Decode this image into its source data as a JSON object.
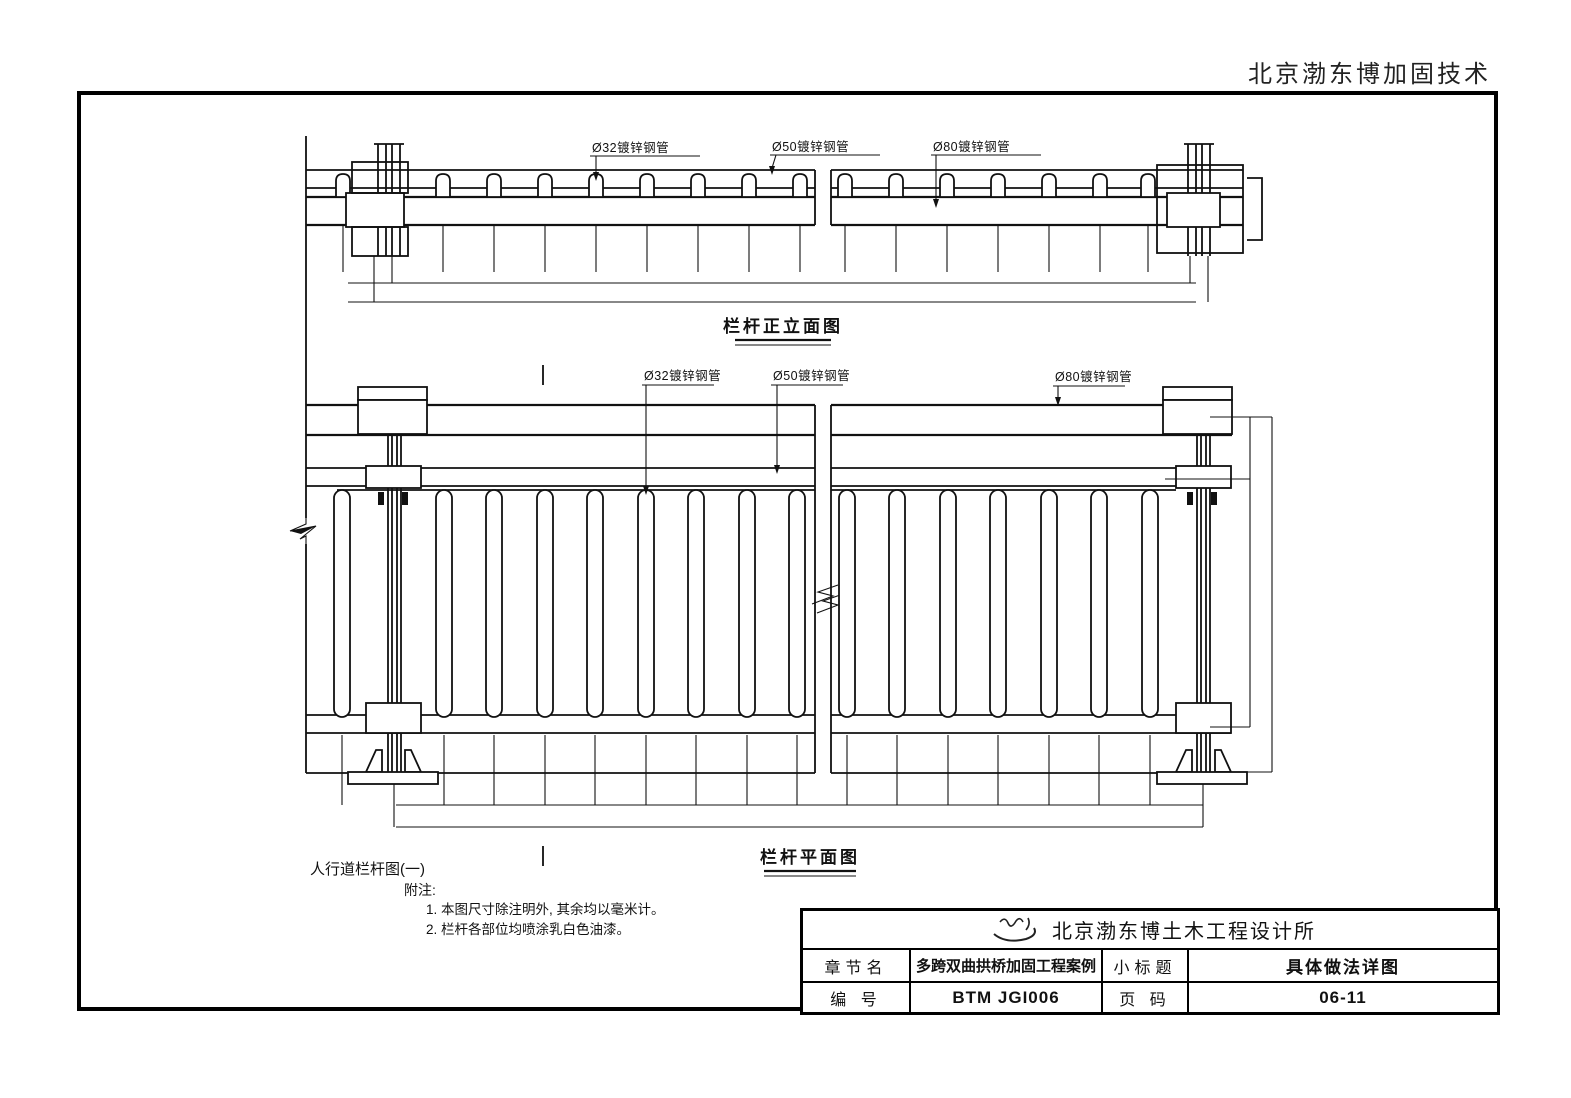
{
  "header": {
    "company_header": "北京渤东博加固技术"
  },
  "drawings": {
    "elevation": {
      "caption": "栏杆正立面图",
      "labels": {
        "pipe32": "Ø32镀锌钢管",
        "pipe50": "Ø50镀锌钢管",
        "pipe80": "Ø80镀锌钢管"
      }
    },
    "plan": {
      "caption": "栏杆平面图",
      "labels": {
        "pipe32": "Ø32镀锌钢管",
        "pipe50": "Ø50镀锌钢管",
        "pipe80": "Ø80镀锌钢管"
      }
    }
  },
  "notes": {
    "figure_title": "人行道栏杆图(一)",
    "notes_label": "附注:",
    "items": [
      "1.  本图尺寸除注明外, 其余均以毫米计。",
      "2.  栏杆各部位均喷涂乳白色油漆。"
    ]
  },
  "title_block": {
    "design_office": "北京渤东博土木工程设计所",
    "chapter_label": "章节名",
    "chapter_value": "多跨双曲拱桥加固工程案例",
    "subtitle_label": "小标题",
    "subtitle_value": "具体做法详图",
    "number_label": "编  号",
    "number_value": "BTM JGI006",
    "page_label": "页  码",
    "page_value": "06-11"
  },
  "colors": {
    "line": "#111111",
    "paper": "#ffffff"
  }
}
